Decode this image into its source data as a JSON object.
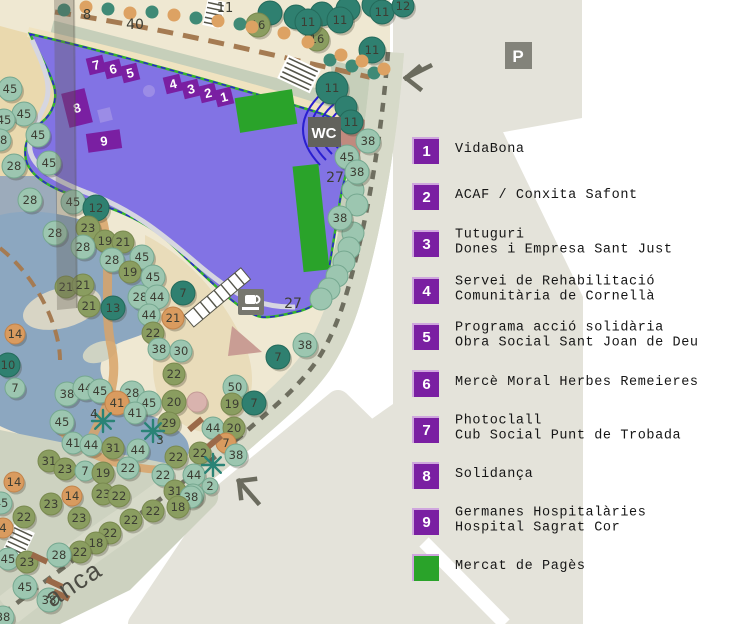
{
  "legend": {
    "items": [
      {
        "marker": "1",
        "color": "#7a1fa2",
        "cy": 150,
        "lines": [
          "VidaBona"
        ]
      },
      {
        "marker": "2",
        "color": "#7a1fa2",
        "cy": 196,
        "lines": [
          "ACAF / Conxita Safont"
        ]
      },
      {
        "marker": "3",
        "color": "#7a1fa2",
        "cy": 243,
        "lines": [
          "Tutuguri",
          "Dones i Empresa Sant Just"
        ]
      },
      {
        "marker": "4",
        "color": "#7a1fa2",
        "cy": 290,
        "lines": [
          "Servei de Rehabilitació",
          "Comunitària de Cornellà"
        ]
      },
      {
        "marker": "5",
        "color": "#7a1fa2",
        "cy": 336,
        "lines": [
          "Programa acció solidària",
          "Obra Social Sant Joan de Deu"
        ]
      },
      {
        "marker": "6",
        "color": "#7a1fa2",
        "cy": 383,
        "lines": [
          "Mercè Moral Herbes Remeieres"
        ]
      },
      {
        "marker": "7",
        "color": "#7a1fa2",
        "cy": 429,
        "lines": [
          "Photoclall",
          "Cub Social Punt de Trobada"
        ]
      },
      {
        "marker": "8",
        "color": "#7a1fa2",
        "cy": 475,
        "lines": [
          "Solidança"
        ]
      },
      {
        "marker": "9",
        "color": "#7a1fa2",
        "cy": 521,
        "lines": [
          "Germanes Hospitalàries",
          "Hospital Sagrat Cor"
        ]
      },
      {
        "marker": "",
        "color": "#2aa32a",
        "cy": 567,
        "lines": [
          "Mercat de Pagès"
        ]
      }
    ]
  },
  "map": {
    "icons": {
      "wc": "WC",
      "parking": "P"
    },
    "street_label": "anca",
    "colors": {
      "purple_area": "#8273e4",
      "stand": "#7a1fa2",
      "stand_light": "#9b8ce6",
      "market_green": "#2aa32a",
      "tree_light": "#9cc6b0",
      "tree_olive": "#8a9d60",
      "tree_dark": "#2f8070",
      "tree_orange": "#d99b5f",
      "tree_pink": "#d9b3ae",
      "dot_teal": "#3f8a76",
      "dot_orange": "#dda263",
      "pond": "#9cabbb",
      "block_gray": "#e4e3da",
      "bound_dash": "#6e6e5f",
      "palm": "#2a8376",
      "bench": "#9a6a49"
    },
    "stands": [
      {
        "n": "7",
        "x": 96,
        "y": 65,
        "w": 17,
        "h": 17,
        "rot": -14
      },
      {
        "n": "6",
        "x": 113,
        "y": 69,
        "w": 17,
        "h": 17,
        "rot": -14
      },
      {
        "n": "5",
        "x": 130,
        "y": 73,
        "w": 17,
        "h": 17,
        "rot": -14
      },
      {
        "n": "4",
        "x": 173,
        "y": 84,
        "w": 17,
        "h": 17,
        "rot": -14
      },
      {
        "n": "3",
        "x": 191,
        "y": 89,
        "w": 17,
        "h": 17,
        "rot": -14
      },
      {
        "n": "2",
        "x": 208,
        "y": 93,
        "w": 17,
        "h": 17,
        "rot": -14
      },
      {
        "n": "1",
        "x": 224,
        "y": 97,
        "w": 17,
        "h": 17,
        "rot": -14
      },
      {
        "n": "8",
        "x": 77,
        "y": 108,
        "w": 24,
        "h": 35,
        "rot": -14
      },
      {
        "n": "9",
        "x": 104,
        "y": 141,
        "w": 34,
        "h": 19,
        "rot": -8
      },
      {
        "n": "",
        "x": 105,
        "y": 115,
        "w": 13,
        "h": 13,
        "rot": -14,
        "light": true
      }
    ],
    "market_rects": [
      {
        "x": 266,
        "y": 111,
        "w": 58,
        "h": 35,
        "rot": -9
      },
      {
        "x": 311,
        "y": 218,
        "w": 26,
        "h": 106,
        "rot": -6
      }
    ],
    "small_dots": [
      {
        "x": 64,
        "y": 10,
        "c": "T"
      },
      {
        "x": 108,
        "y": 9,
        "c": "T"
      },
      {
        "x": 152,
        "y": 12,
        "c": "T"
      },
      {
        "x": 196,
        "y": 18,
        "c": "T"
      },
      {
        "x": 240,
        "y": 24,
        "c": "T"
      },
      {
        "x": 330,
        "y": 60,
        "c": "T"
      },
      {
        "x": 352,
        "y": 66,
        "c": "T"
      },
      {
        "x": 374,
        "y": 73,
        "c": "T"
      },
      {
        "x": 86,
        "y": 7,
        "c": "R"
      },
      {
        "x": 130,
        "y": 13,
        "c": "R"
      },
      {
        "x": 174,
        "y": 15,
        "c": "R"
      },
      {
        "x": 218,
        "y": 21,
        "c": "R"
      },
      {
        "x": 252,
        "y": 27,
        "c": "R"
      },
      {
        "x": 284,
        "y": 33,
        "c": "R"
      },
      {
        "x": 308,
        "y": 42,
        "c": "R"
      },
      {
        "x": 341,
        "y": 55,
        "c": "R"
      },
      {
        "x": 362,
        "y": 61,
        "c": "R"
      },
      {
        "x": 384,
        "y": 69,
        "c": "R"
      }
    ],
    "trees": [
      [
        "",
        "D",
        270,
        13,
        12
      ],
      [
        "",
        "D",
        296,
        17,
        12
      ],
      [
        "",
        "D",
        322,
        14,
        12
      ],
      [
        "",
        "D",
        348,
        9,
        12
      ],
      [
        "",
        "D",
        374,
        5,
        12
      ],
      [
        "16",
        "O",
        258,
        25,
        12
      ],
      [
        "16",
        "O",
        317,
        39,
        12
      ],
      [
        "11",
        "D",
        308,
        22,
        13
      ],
      [
        "11",
        "D",
        340,
        20,
        13
      ],
      [
        "11",
        "D",
        382,
        12,
        12
      ],
      [
        "12",
        "D",
        403,
        6,
        11
      ],
      [
        "11",
        "D",
        372,
        50,
        13
      ],
      [
        "11",
        "D",
        332,
        88,
        16
      ],
      [
        "",
        "D",
        346,
        107,
        11
      ],
      [
        "11",
        "D",
        351,
        122,
        12
      ],
      [
        "38",
        "L",
        368,
        141,
        12
      ],
      [
        "45",
        "L",
        347,
        157,
        12
      ],
      [
        "38",
        "L",
        357,
        172,
        12
      ],
      [
        "38",
        "L",
        340,
        218,
        12
      ],
      [
        "38",
        "L",
        305,
        345,
        12
      ],
      [
        "7",
        "D",
        278,
        357,
        12
      ],
      [
        "50",
        "L",
        235,
        387,
        12
      ],
      [
        "19",
        "O",
        232,
        404,
        11
      ],
      [
        "7",
        "D",
        254,
        403,
        12
      ],
      [
        "44",
        "L",
        213,
        428,
        11
      ],
      [
        "20",
        "O",
        234,
        428,
        11
      ],
      [
        "7",
        "R",
        226,
        443,
        10
      ],
      [
        "38",
        "L",
        236,
        455,
        11
      ],
      [
        "22",
        "O",
        200,
        453,
        11
      ],
      [
        "44",
        "L",
        194,
        475,
        11
      ],
      [
        "38",
        "L",
        193,
        495,
        11
      ],
      [
        "2",
        "L",
        210,
        486,
        8
      ],
      [
        "45",
        "L",
        10,
        89,
        12
      ],
      [
        "45",
        "L",
        24,
        114,
        12
      ],
      [
        "45",
        "L",
        4,
        120,
        11
      ],
      [
        "38",
        "L",
        0,
        140,
        11
      ],
      [
        "45",
        "L",
        38,
        135,
        12
      ],
      [
        "45",
        "L",
        49,
        163,
        12
      ],
      [
        "28",
        "L",
        14,
        166,
        12
      ],
      [
        "28",
        "L",
        30,
        200,
        12
      ],
      [
        "45",
        "L",
        73,
        202,
        12
      ],
      [
        "12",
        "D",
        96,
        208,
        13
      ],
      [
        "28",
        "L",
        55,
        233,
        12
      ],
      [
        "23",
        "O",
        88,
        228,
        12
      ],
      [
        "19",
        "O",
        105,
        241,
        11
      ],
      [
        "21",
        "O",
        123,
        242,
        11
      ],
      [
        "28",
        "L",
        83,
        247,
        12
      ],
      [
        "28",
        "L",
        112,
        260,
        12
      ],
      [
        "45",
        "L",
        142,
        257,
        12
      ],
      [
        "19",
        "O",
        130,
        272,
        11
      ],
      [
        "45",
        "L",
        153,
        277,
        12
      ],
      [
        "21",
        "O",
        66,
        287,
        11
      ],
      [
        "21",
        "O",
        83,
        285,
        11
      ],
      [
        "21",
        "O",
        89,
        306,
        11
      ],
      [
        "13",
        "D",
        113,
        308,
        12
      ],
      [
        "28",
        "L",
        140,
        297,
        12
      ],
      [
        "44",
        "L",
        157,
        297,
        12
      ],
      [
        "7",
        "D",
        183,
        293,
        12
      ],
      [
        "44",
        "L",
        149,
        315,
        11
      ],
      [
        "21",
        "R",
        173,
        318,
        11
      ],
      [
        "22",
        "O",
        153,
        333,
        11
      ],
      [
        "38",
        "L",
        159,
        349,
        11
      ],
      [
        "30",
        "L",
        181,
        351,
        11
      ],
      [
        "22",
        "O",
        174,
        374,
        11
      ],
      [
        "14",
        "R",
        15,
        334,
        10
      ],
      [
        "10",
        "D",
        8,
        365,
        12
      ],
      [
        "7",
        "L",
        15,
        388,
        10
      ],
      [
        "38",
        "L",
        67,
        394,
        12
      ],
      [
        "44",
        "L",
        85,
        388,
        12
      ],
      [
        "45",
        "L",
        100,
        391,
        12
      ],
      [
        "28",
        "L",
        132,
        393,
        12
      ],
      [
        "41",
        "R",
        117,
        403,
        12
      ],
      [
        "45",
        "L",
        149,
        403,
        12
      ],
      [
        "41",
        "L",
        135,
        413,
        11
      ],
      [
        "20",
        "O",
        174,
        402,
        12
      ],
      [
        "",
        "P",
        197,
        402,
        10
      ],
      [
        "45",
        "L",
        62,
        422,
        12
      ],
      [
        "29",
        "O",
        169,
        423,
        11
      ],
      [
        "41",
        "L",
        73,
        443,
        11
      ],
      [
        "44",
        "L",
        91,
        445,
        11
      ],
      [
        "31",
        "O",
        113,
        448,
        11
      ],
      [
        "44",
        "L",
        138,
        450,
        11
      ],
      [
        "31",
        "O",
        49,
        461,
        11
      ],
      [
        "23",
        "O",
        65,
        469,
        11
      ],
      [
        "7",
        "L",
        85,
        471,
        10
      ],
      [
        "19",
        "O",
        103,
        473,
        11
      ],
      [
        "22",
        "L",
        128,
        468,
        11
      ],
      [
        "22",
        "O",
        176,
        457,
        11
      ],
      [
        "22",
        "L",
        163,
        475,
        11
      ],
      [
        "14",
        "R",
        14,
        482,
        10
      ],
      [
        "45",
        "L",
        1,
        503,
        11
      ],
      [
        "23",
        "O",
        51,
        504,
        11
      ],
      [
        "14",
        "R",
        72,
        496,
        10
      ],
      [
        "23",
        "O",
        103,
        494,
        11
      ],
      [
        "22",
        "O",
        119,
        496,
        11
      ],
      [
        "23",
        "O",
        79,
        518,
        11
      ],
      [
        "22",
        "O",
        24,
        517,
        11
      ],
      [
        "4",
        "R",
        3,
        528,
        10
      ],
      [
        "31",
        "O",
        175,
        491,
        11
      ],
      [
        "38",
        "L",
        191,
        497,
        11
      ],
      [
        "22",
        "O",
        153,
        511,
        11
      ],
      [
        "18",
        "O",
        178,
        507,
        11
      ],
      [
        "22",
        "O",
        131,
        520,
        11
      ],
      [
        "22",
        "O",
        110,
        533,
        11
      ],
      [
        "18",
        "O",
        96,
        543,
        11
      ],
      [
        "22",
        "O",
        80,
        552,
        11
      ],
      [
        "28",
        "L",
        59,
        555,
        12
      ],
      [
        "45",
        "L",
        8,
        559,
        11
      ],
      [
        "23",
        "O",
        27,
        562,
        11
      ],
      [
        "45",
        "L",
        25,
        587,
        12
      ],
      [
        "38",
        "L",
        49,
        600,
        12
      ],
      [
        "38",
        "L",
        3,
        617,
        11
      ]
    ],
    "hedge": [
      [
        353,
        190
      ],
      [
        357,
        205
      ],
      [
        353,
        233
      ],
      [
        349,
        248
      ],
      [
        344,
        262
      ],
      [
        337,
        276
      ],
      [
        329,
        289
      ],
      [
        321,
        299
      ]
    ],
    "palms": [
      [
        103,
        421
      ],
      [
        153,
        431
      ],
      [
        213,
        465
      ]
    ],
    "area_labels": [
      {
        "t": "8",
        "x": 87,
        "y": 19,
        "s": 13
      },
      {
        "t": "40",
        "x": 135,
        "y": 29,
        "s": 14
      },
      {
        "t": "11",
        "x": 225,
        "y": 12,
        "s": 13
      },
      {
        "t": "27",
        "x": 335,
        "y": 182,
        "s": 14
      },
      {
        "t": "27",
        "x": 293,
        "y": 308,
        "s": 14
      },
      {
        "t": "3",
        "x": 160,
        "y": 444,
        "s": 12
      },
      {
        "t": "4",
        "x": 94,
        "y": 418,
        "s": 12
      }
    ]
  }
}
